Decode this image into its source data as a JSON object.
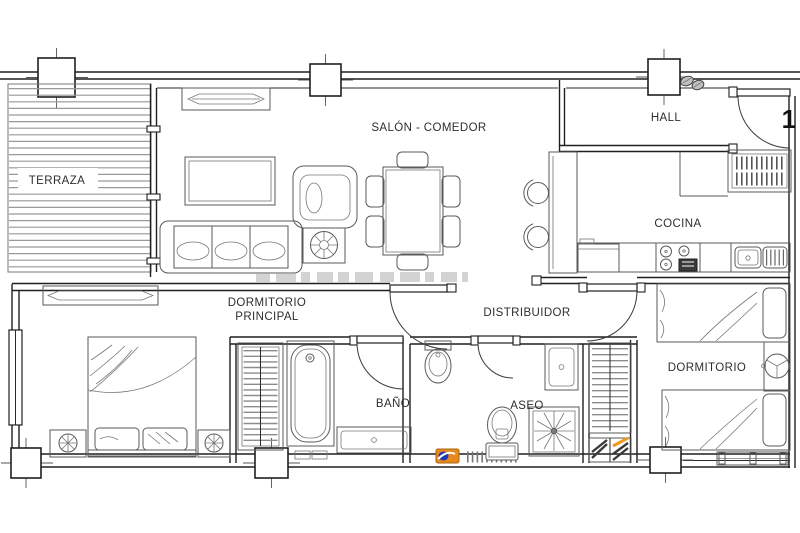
{
  "unit": {
    "number": "1"
  },
  "rooms": {
    "terraza": "TERRAZA",
    "salon_comedor": "SALÓN - COMEDOR",
    "hall": "HALL",
    "cocina": "COCINA",
    "dormitorio_principal": {
      "line1": "DORMITORIO",
      "line2": "PRINCIPAL"
    },
    "distribuidor": "DISTRIBUIDOR",
    "bano": "BAÑO",
    "aseo": "ASEO",
    "dormitorio": "DORMITORIO"
  },
  "branding": {
    "logo_orange": "#E8891C",
    "logo_blue": "#2038B8",
    "logo_white": "#FFFFFF"
  },
  "drawing": {
    "wall_color": "#1f1f1f",
    "furniture_color": "#5a5a5a",
    "hatch_color": "#8c8c8c",
    "watermark_color": "#a8a8a8"
  }
}
